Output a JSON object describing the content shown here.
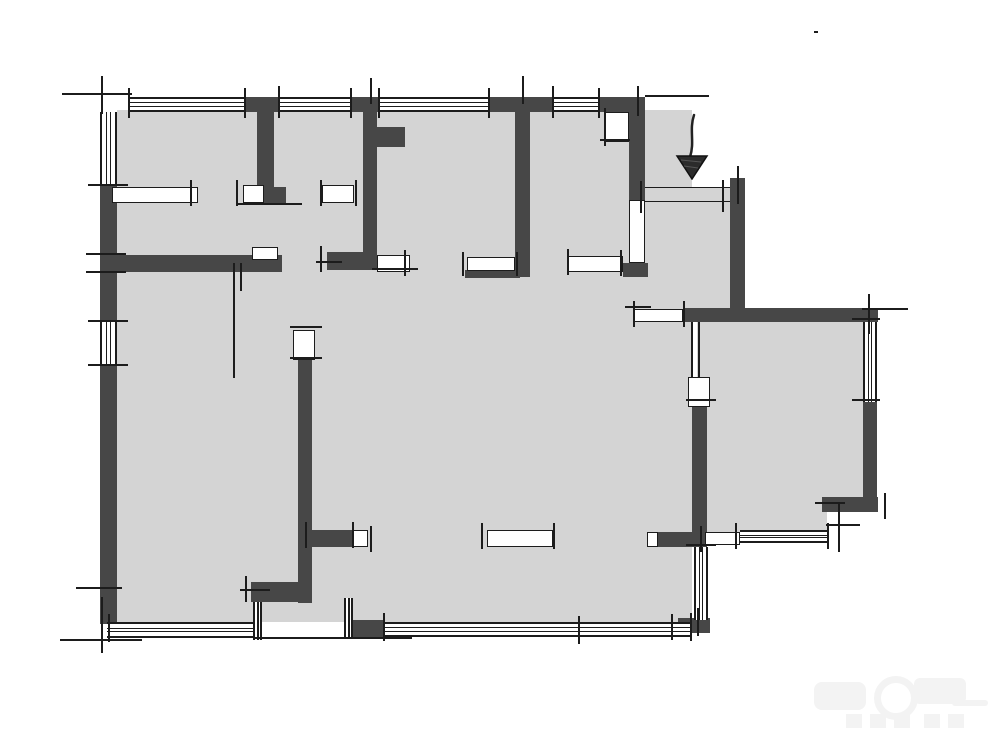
{
  "meta": {
    "kind": "architectural-floor-plan-sketch",
    "description": "Hand-drafted style apartment floor plan: dark walls, light gray floor, window bands, door openings, entrance arrow at top right. No text labels visible.",
    "canvas": {
      "width": 1000,
      "height": 741
    }
  },
  "colors": {
    "background": "#ffffff",
    "floor": "#d4d4d4",
    "wall": "#474747",
    "line": "#1c1c1c",
    "watermark": "#f3f3f3"
  },
  "entrance": {
    "marker": "down-arrow",
    "x": 668,
    "y": 112,
    "width": 44,
    "height": 68
  },
  "watermark": {
    "x": 812,
    "y": 670,
    "width": 180,
    "height": 64,
    "legible": false
  },
  "plan": {
    "floors": [
      [
        117,
        110,
        575,
        512
      ],
      [
        645,
        187,
        87,
        135
      ],
      [
        697,
        315,
        170,
        197
      ],
      [
        697,
        430,
        130,
        102
      ]
    ],
    "walls": [
      [
        244,
        97,
        34,
        15
      ],
      [
        350,
        97,
        28,
        15
      ],
      [
        488,
        97,
        64,
        15
      ],
      [
        598,
        97,
        47,
        15
      ],
      [
        100,
        185,
        17,
        137
      ],
      [
        100,
        366,
        17,
        236
      ],
      [
        100,
        600,
        17,
        24
      ],
      [
        257,
        112,
        17,
        76
      ],
      [
        264,
        187,
        22,
        17
      ],
      [
        100,
        255,
        182,
        17
      ],
      [
        363,
        112,
        14,
        158
      ],
      [
        377,
        127,
        28,
        20
      ],
      [
        327,
        252,
        50,
        18
      ],
      [
        515,
        112,
        15,
        165
      ],
      [
        465,
        270,
        55,
        8
      ],
      [
        629,
        112,
        16,
        88
      ],
      [
        623,
        263,
        25,
        14
      ],
      [
        730,
        178,
        15,
        144
      ],
      [
        683,
        308,
        195,
        14
      ],
      [
        863,
        400,
        14,
        112
      ],
      [
        822,
        497,
        56,
        15
      ],
      [
        658,
        532,
        47,
        15
      ],
      [
        692,
        407,
        15,
        140
      ],
      [
        678,
        618,
        32,
        15
      ],
      [
        298,
        360,
        14,
        243
      ],
      [
        312,
        530,
        41,
        17
      ],
      [
        251,
        582,
        61,
        20
      ],
      [
        353,
        620,
        30,
        17
      ]
    ],
    "windowsH": [
      [
        128,
        97,
        116,
        15
      ],
      [
        278,
        97,
        72,
        15
      ],
      [
        380,
        97,
        108,
        15
      ],
      [
        552,
        97,
        46,
        15
      ],
      [
        107,
        622,
        150,
        16
      ],
      [
        383,
        622,
        307,
        15
      ],
      [
        740,
        530,
        87,
        13
      ]
    ],
    "windowsV": [
      [
        100,
        112,
        17,
        73
      ],
      [
        100,
        322,
        17,
        44
      ],
      [
        863,
        322,
        14,
        80
      ],
      [
        694,
        547,
        14,
        73
      ],
      [
        253,
        602,
        9,
        38
      ],
      [
        344,
        598,
        9,
        40
      ]
    ],
    "openings": [
      [
        112,
        187,
        86,
        16
      ],
      [
        243,
        185,
        21,
        18
      ],
      [
        322,
        185,
        32,
        18
      ],
      [
        377,
        255,
        33,
        17
      ],
      [
        467,
        257,
        48,
        14
      ],
      [
        567,
        256,
        56,
        16
      ],
      [
        605,
        112,
        24,
        30
      ],
      [
        629,
        200,
        16,
        63
      ],
      [
        633,
        309,
        50,
        13
      ],
      [
        688,
        377,
        22,
        30
      ],
      [
        293,
        330,
        22,
        30
      ],
      [
        353,
        530,
        15,
        17
      ],
      [
        487,
        530,
        66,
        17
      ],
      [
        252,
        247,
        26,
        13
      ],
      [
        705,
        532,
        35,
        13
      ],
      [
        647,
        532,
        11,
        15
      ]
    ],
    "thresholds": [
      [
        645,
        187,
        87,
        15
      ]
    ],
    "ticks": [
      [
        62,
        93,
        70,
        "h"
      ],
      [
        101,
        76,
        38,
        "v"
      ],
      [
        128,
        88,
        30,
        "v"
      ],
      [
        244,
        88,
        30,
        "v"
      ],
      [
        278,
        86,
        32,
        "v"
      ],
      [
        350,
        88,
        30,
        "v"
      ],
      [
        378,
        88,
        30,
        "v"
      ],
      [
        488,
        88,
        30,
        "v"
      ],
      [
        552,
        86,
        32,
        "v"
      ],
      [
        598,
        88,
        30,
        "v"
      ],
      [
        637,
        86,
        30,
        "v"
      ],
      [
        370,
        78,
        26,
        "v"
      ],
      [
        522,
        76,
        28,
        "v"
      ],
      [
        645,
        95,
        64,
        "h"
      ],
      [
        814,
        31,
        4,
        "h"
      ],
      [
        88,
        184,
        40,
        "h"
      ],
      [
        86,
        253,
        40,
        "h"
      ],
      [
        86,
        271,
        40,
        "h"
      ],
      [
        88,
        320,
        40,
        "h"
      ],
      [
        88,
        364,
        40,
        "h"
      ],
      [
        60,
        639,
        82,
        "h"
      ],
      [
        101,
        597,
        56,
        "v"
      ],
      [
        76,
        587,
        46,
        "h"
      ],
      [
        108,
        614,
        28,
        "v"
      ],
      [
        190,
        180,
        26,
        "v"
      ],
      [
        236,
        180,
        26,
        "v"
      ],
      [
        238,
        203,
        64,
        "h"
      ],
      [
        320,
        180,
        26,
        "v"
      ],
      [
        355,
        180,
        26,
        "v"
      ],
      [
        320,
        246,
        26,
        "v"
      ],
      [
        316,
        261,
        26,
        "h"
      ],
      [
        404,
        250,
        26,
        "v"
      ],
      [
        372,
        268,
        46,
        "h"
      ],
      [
        462,
        252,
        24,
        "v"
      ],
      [
        516,
        252,
        24,
        "v"
      ],
      [
        567,
        249,
        26,
        "v"
      ],
      [
        620,
        250,
        26,
        "v"
      ],
      [
        600,
        139,
        30,
        "h"
      ],
      [
        604,
        108,
        38,
        "v"
      ],
      [
        640,
        181,
        32,
        "v"
      ],
      [
        722,
        180,
        32,
        "v"
      ],
      [
        737,
        166,
        38,
        "v"
      ],
      [
        691,
        322,
        56,
        "v"
      ],
      [
        698,
        322,
        56,
        "v"
      ],
      [
        633,
        301,
        26,
        "v"
      ],
      [
        683,
        301,
        26,
        "v"
      ],
      [
        625,
        306,
        26,
        "h"
      ],
      [
        868,
        294,
        40,
        "v"
      ],
      [
        862,
        308,
        46,
        "h"
      ],
      [
        852,
        318,
        28,
        "h"
      ],
      [
        852,
        399,
        28,
        "h"
      ],
      [
        815,
        502,
        30,
        "h"
      ],
      [
        838,
        504,
        48,
        "v"
      ],
      [
        826,
        524,
        34,
        "h"
      ],
      [
        884,
        493,
        26,
        "v"
      ],
      [
        735,
        523,
        26,
        "v"
      ],
      [
        827,
        523,
        26,
        "v"
      ],
      [
        700,
        526,
        26,
        "v"
      ],
      [
        686,
        399,
        30,
        "h"
      ],
      [
        686,
        544,
        30,
        "h"
      ],
      [
        697,
        608,
        28,
        "v"
      ],
      [
        671,
        614,
        26,
        "v"
      ],
      [
        383,
        613,
        28,
        "v"
      ],
      [
        690,
        613,
        28,
        "v"
      ],
      [
        578,
        616,
        28,
        "v"
      ],
      [
        340,
        637,
        72,
        "h"
      ],
      [
        253,
        637,
        104,
        "h"
      ],
      [
        290,
        326,
        32,
        "h"
      ],
      [
        290,
        357,
        32,
        "h"
      ],
      [
        305,
        522,
        26,
        "v"
      ],
      [
        352,
        522,
        26,
        "v"
      ],
      [
        370,
        526,
        26,
        "v"
      ],
      [
        245,
        576,
        26,
        "v"
      ],
      [
        240,
        589,
        30,
        "h"
      ],
      [
        481,
        523,
        26,
        "v"
      ],
      [
        553,
        523,
        26,
        "v"
      ],
      [
        233,
        263,
        115,
        "v"
      ],
      [
        240,
        263,
        28,
        "v"
      ]
    ]
  }
}
